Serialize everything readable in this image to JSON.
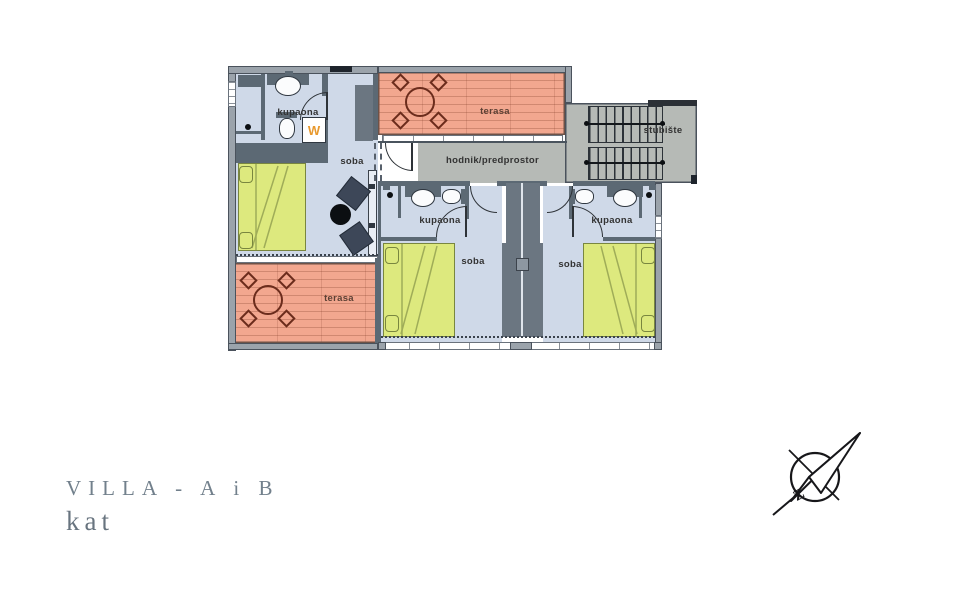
{
  "title": {
    "line1": "VILLA - A i B",
    "line2": "kat"
  },
  "rooms": {
    "kupaona_a": "kupaona",
    "soba_a": "soba",
    "terasa_top": "terasa",
    "terasa_bottom": "terasa",
    "hodnik": "hodnik/predprostor",
    "stubiste": "stubište",
    "kupaona_b1": "kupaona",
    "soba_b1": "soba",
    "kupaona_b2": "kupaona",
    "soba_b2": "soba"
  },
  "appliances": {
    "washing_machine": "W"
  },
  "compass": {
    "letter": "Z"
  },
  "colors": {
    "wall": "#5c6974",
    "outer_wall": "#9ba3ab",
    "floor": "#cfd9e8",
    "terrace": "#f2a78f",
    "corridor": "#b6bab6",
    "bed": "#dde97e",
    "chair": "#3d4758",
    "title_text": "#72808c",
    "washer_letter": "#e8992e"
  }
}
